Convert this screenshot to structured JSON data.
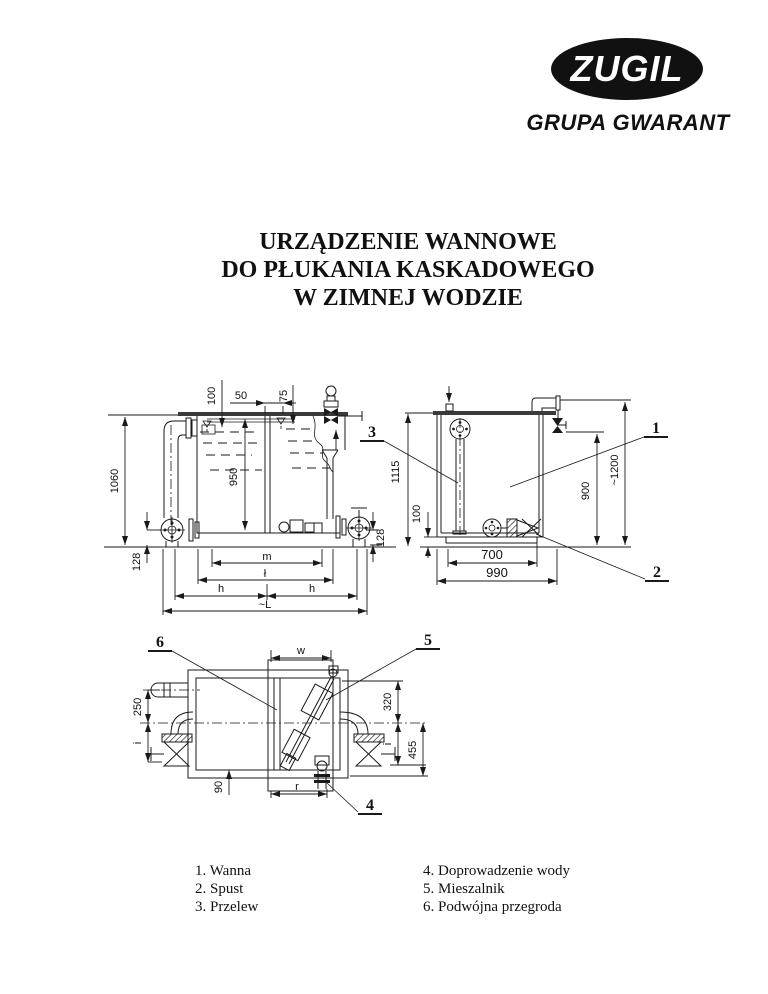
{
  "logo": {
    "brand": "ZUGIL",
    "group": "GRUPA GWARANT"
  },
  "title": {
    "line1": "URZĄDZENIE WANNOWE",
    "line2": "DO PŁUKANIA KASKADOWEGO",
    "line3": "W ZIMNEJ WODZIE"
  },
  "front_view": {
    "dim_100": "100",
    "dim_50": "50",
    "dim_75": "75",
    "dim_950": "950",
    "dim_1060": "1060",
    "dim_128_left": "128",
    "dim_128_right": "128",
    "dim_m": "m",
    "dim_l": "ł",
    "dim_h_left": "h",
    "dim_h_right": "h",
    "dim_L": "~L"
  },
  "side_view": {
    "dim_1115": "1115",
    "dim_100": "100",
    "dim_700": "700",
    "dim_990": "990",
    "dim_900": "900",
    "dim_1200": "~1200",
    "label_1": "1",
    "label_2": "2",
    "label_3": "3"
  },
  "top_view": {
    "dim_w": "w",
    "dim_250": "250",
    "dim_i_left": "i",
    "dim_90": "90",
    "dim_r": "r",
    "dim_320": "320",
    "dim_i_right": "i",
    "dim_455": "455",
    "label_4": "4",
    "label_5": "5",
    "label_6": "6"
  },
  "legend": {
    "items_left": [
      "1. Wanna",
      "2. Spust",
      "3. Przelew"
    ],
    "items_right": [
      "4. Doprowadzenie wody",
      "5. Mieszalnik",
      "6. Podwójna przegroda"
    ]
  },
  "colors": {
    "ink": "#1a1a1a",
    "paper": "#ffffff"
  }
}
